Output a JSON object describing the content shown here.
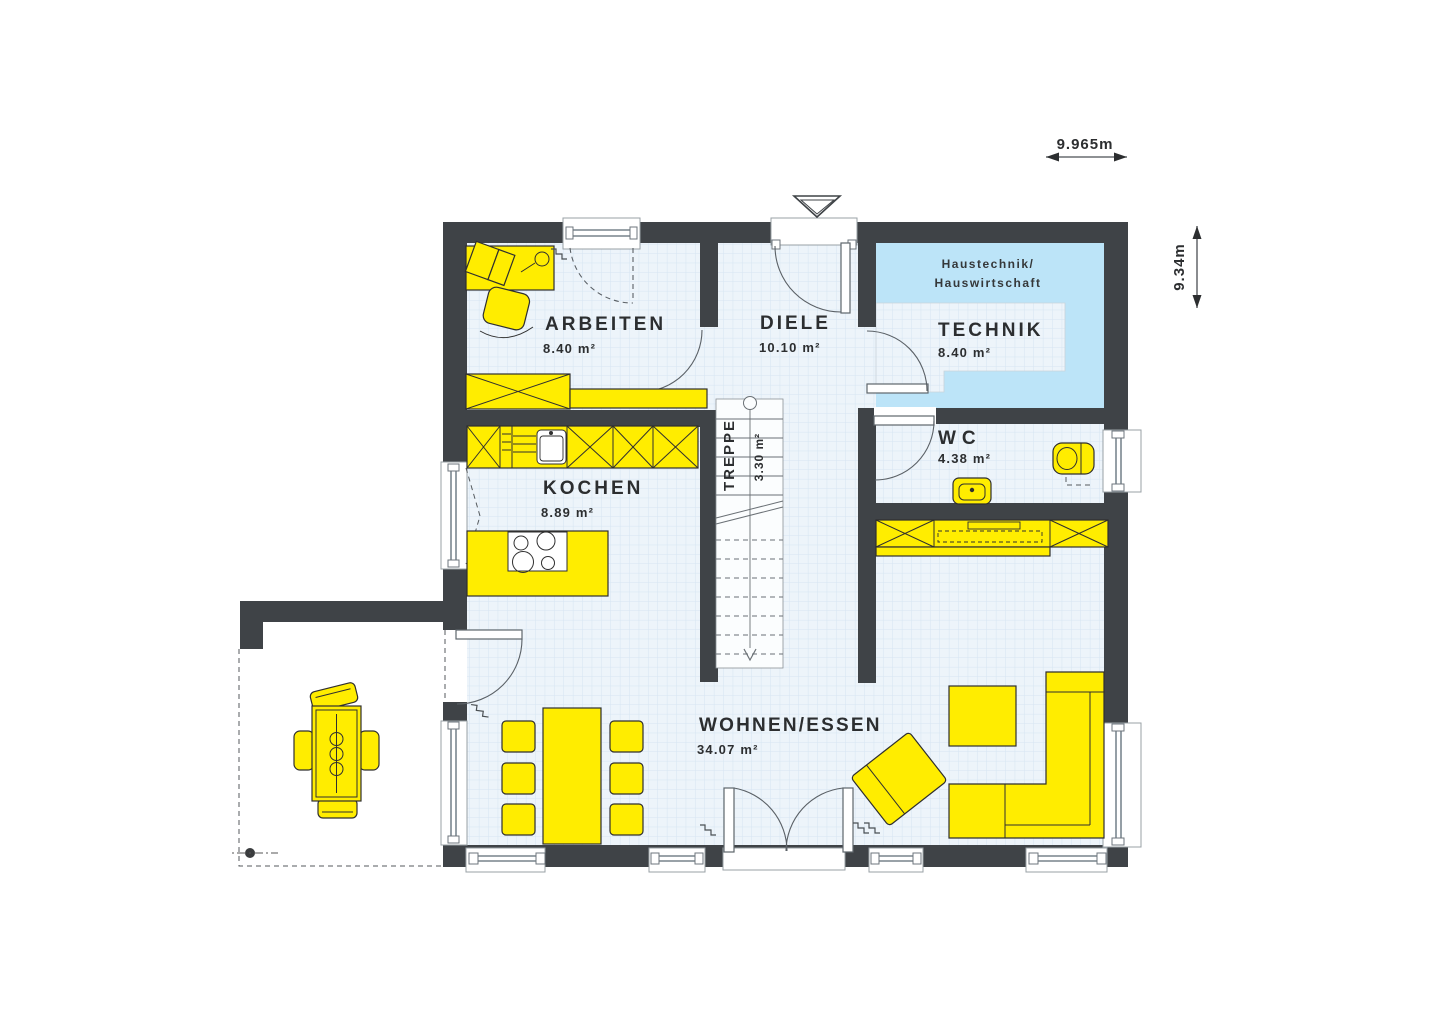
{
  "page": {
    "type": "architectural-floor-plan",
    "background": "#ffffff"
  },
  "rooms": [
    {
      "key": "arbeiten",
      "name": "ARBEITEN",
      "area": "8.40 m²"
    },
    {
      "key": "diele",
      "name": "DIELE",
      "area": "10.10 m²"
    },
    {
      "key": "technik",
      "name": "TECHNIK",
      "area": "8.40 m²",
      "note1": "Haustechnik/",
      "note2": "Hauswirtschaft"
    },
    {
      "key": "treppe",
      "name": "TREPPE",
      "area": "3.30 m²"
    },
    {
      "key": "wc",
      "name": "WC",
      "area": "4.38 m²"
    },
    {
      "key": "kochen",
      "name": "KOCHEN",
      "area": "8.89 m²"
    },
    {
      "key": "wohnen_essen",
      "name": "WOHNEN/ESSEN",
      "area": "34.07 m²"
    }
  ],
  "dimensions": {
    "width": "9.965m",
    "height": "9.34m"
  },
  "colors": {
    "wall": "#3f4347",
    "floor": "#edf4fa",
    "floor_grid": "#d6e5f2",
    "technik_floor": "#bce4f8",
    "furniture": "#ffed00",
    "outline": "#2f2f2f"
  }
}
